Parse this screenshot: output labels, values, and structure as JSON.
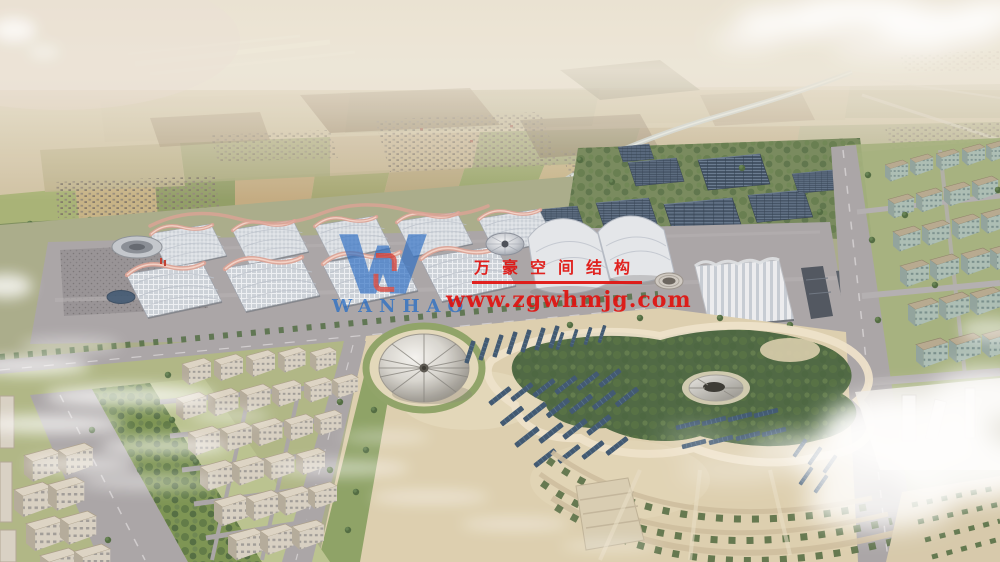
{
  "watermark": {
    "company": "万豪空间结构",
    "website": "www.zgwhmjg.com"
  },
  "logo": {
    "monogram": "W",
    "wordmark": "WANHAO"
  },
  "colors": {
    "watermark_red": "#e0120f",
    "logo_blue": "#2e6fc2",
    "logo_red": "#d6362b",
    "hall_ridge_pink": "#dba193",
    "solar_panel_blue": "#3a546e",
    "road_gray": "#a8a4a6",
    "sand_beige": "#ddcfae",
    "tree_green": "#4c683d",
    "hall_roof_gray": "#ccd2da",
    "farmland_tan": "#c9b88f",
    "haze_white": "#ece6d8"
  },
  "scene": {
    "description": "Aerial rendering: exhibition halls with pink-ridged gridshell roofs, solar farm, central park with tent pavilion, residential blocks, hazy farmland horizon",
    "regions": [
      "farmland-horizon",
      "river-canal",
      "tree-line",
      "exhibition-halls",
      "dome-pavilion",
      "station-hall",
      "solar-farm",
      "right-city-district",
      "left-city-district",
      "central-park",
      "event-tent",
      "sunken-pavilion",
      "terraced-tree-rows",
      "clouds"
    ]
  }
}
